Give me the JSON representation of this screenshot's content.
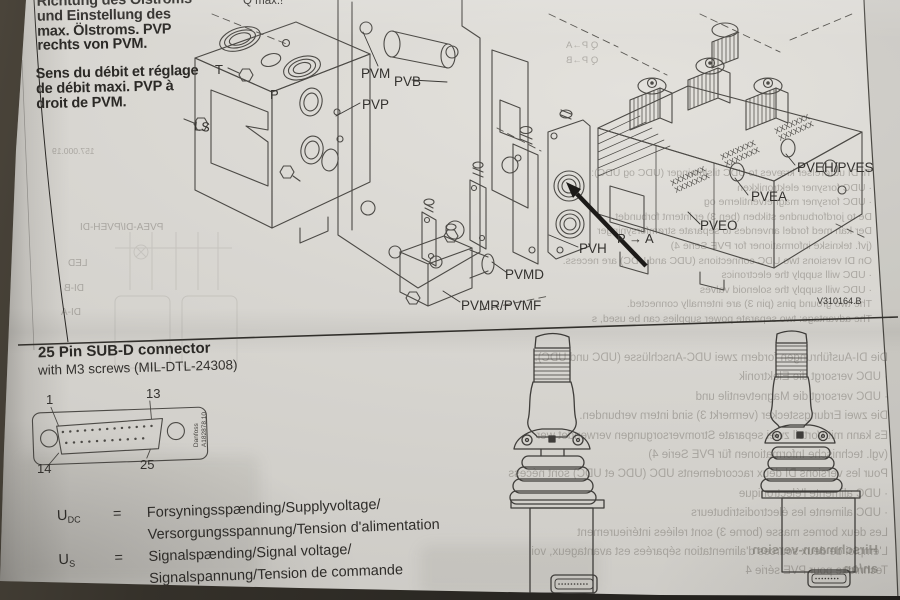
{
  "top_section": {
    "heading_de": [
      "Richtung des Ölstroms",
      "und Einstellung des",
      "max. Ölstroms. PVP",
      "rechts von PVM."
    ],
    "heading_fr": [
      "Sens du débit et réglage",
      "de débit maxi. PVP à",
      "droit de PVM."
    ],
    "q_max": "Q max.!",
    "labels": {
      "pvm": "PVM",
      "pvb": "PVB",
      "pvp": "PVP",
      "pvh": "PVH",
      "pvmd": "PVMD",
      "pvmr": "PVMR/PVMF",
      "pveh": "PVEH/PVES",
      "pvea": "PVEA",
      "pveo": "PVEO",
      "flow": "P → A",
      "code": "V310164.B",
      "port_t": "T",
      "port_p": "P",
      "port_ls": "LS"
    },
    "hatch_marks": "XXXXXXX"
  },
  "bottom_section": {
    "connector_title": "25 Pin SUB-D connector",
    "connector_subtitle": "with M3 screws (MIL-DTL-24308)",
    "pin_labels": {
      "p1": "1",
      "p13": "13",
      "p14": "14",
      "p25": "25"
    },
    "side_label_1": "Danfoss",
    "side_label_2": "A182878.10",
    "voltage_defs": [
      {
        "symbol": "U",
        "subscript": "DC",
        "equals": "=",
        "line1": "Forsyningsspænding/Supplyvoltage/",
        "line2": "Versorgungsspannung/Tension d'alimentation"
      },
      {
        "symbol": "U",
        "subscript": "S",
        "equals": "=",
        "line1": "Signalspænding/Signal voltage/",
        "line2": "Signalspannung/Tension de commande"
      }
    ]
  },
  "bleedthrough": {
    "doc_number": "157.000.19",
    "flow_table": [
      "Q P→A",
      "Q P→B"
    ],
    "left_labels": [
      "PVEA-DI/PVEH-DI",
      "LED",
      "DI-B",
      "DI-A"
    ],
    "top_right": [
      "Til DI udførelser kræves to UDC tilslutninger (UDC og UDC):",
      "· UDC forsyner elektronikken",
      "· UDC forsyner magnetventilerne og",
      "De to jordforbundne stikben (ben 3) er internt forbundet.",
      "Der kan med fordel anvendes to separate strømforsyninger",
      "(jvf. tekniske informationer for PVE Serie 4)",
      "On DI versions two UDC connections (UDC and UDC) are necess.",
      "· UDC will supply the electronics",
      "· UDC will supply the solenoid valves",
      "The two ground pins (pin 3) are internally connected.",
      "The advantage: two separate power supplies can be used, s"
    ],
    "bottom": [
      "Die DI-Ausführungen fordern zwei UDC-Anschlüsse (UDC und UDC):",
      "· UDC versorgt die Elektronik",
      "· UDC versorgt die Magnetventile und",
      "Die zwei Erdungsstecker (vermerkt 3) sind intern verbunden.",
      "Es kann mit Vorteil zwei separate Stromversorgungen verwendet wer",
      "(vgl. technische Informationen für PVE Serie 4)",
      "Pour les versions DI deux raccordements UDC (UDC et UDC) sont nécess",
      "· UDC alimente l'électronique",
      "· UDC alimente les électrodistributeurs",
      "Les deux bornes masse (borne 3) sont reliées intérieurement",
      "L'emploi de deux sources d'alimentation séparées est avantageux, voi",
      "Technique pour PVE série 4"
    ],
    "bottom_bold": [
      "Hirschmann-version",
      "an/on"
    ]
  },
  "colors": {
    "paper": "#d8d6d1",
    "background": "#2f2c27",
    "ink": "#2b2926",
    "line": "#4c4a46"
  }
}
